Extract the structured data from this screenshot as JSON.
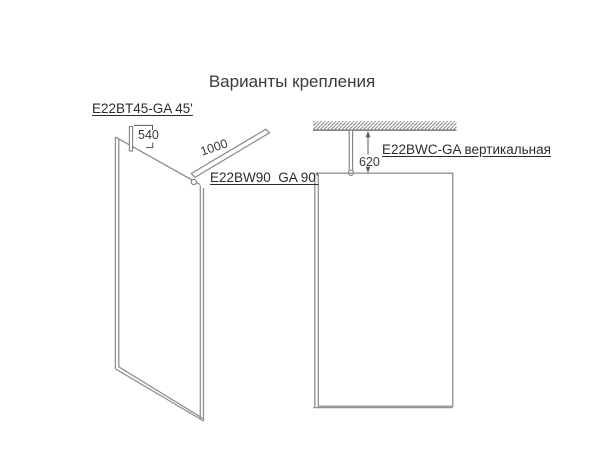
{
  "title": "Варианты крепления",
  "labels": {
    "bracket_45": "E22BT45-GA 45'",
    "bracket_90": "E22BW90  GA 90'",
    "vertical": "E22BWC-GA вертикальная"
  },
  "dimensions": {
    "d540": "540",
    "d1000": "1000",
    "d620": "620"
  },
  "colors": {
    "panel_line": "#8c9196",
    "dim_line": "#55585c",
    "text": "#2c2c2c"
  }
}
